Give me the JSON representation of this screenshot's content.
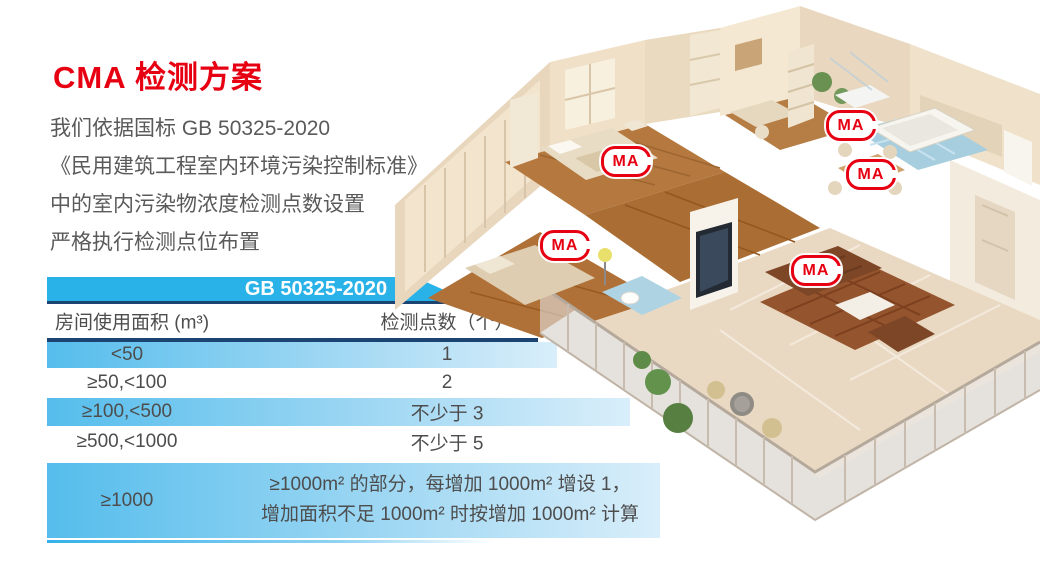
{
  "title": "CMA 检测方案",
  "intro": {
    "line1": "我们依据国标 GB 50325-2020",
    "line2": "《民用建筑工程室内环境污染控制标准》",
    "line3": "中的室内污染物浓度检测点数设置",
    "line4": "严格执行检测点位布置"
  },
  "table": {
    "header": "GB 50325-2020",
    "col1_header": "房间使用面积 (m³)",
    "col2_header": "检测点数（个）",
    "rows": [
      {
        "area": "<50",
        "points": "1"
      },
      {
        "area": "≥50,<100",
        "points": "2"
      },
      {
        "area": "≥100,<500",
        "points": "不少于 3"
      },
      {
        "area": "≥500,<1000",
        "points": "不少于 5"
      }
    ],
    "last_row": {
      "area": "≥1000",
      "points_line1": "≥1000m² 的部分，每增加 1000m² 增设 1，",
      "points_line2": "增加面积不足 1000m² 时按增加 1000m² 计算"
    }
  },
  "floorplan": {
    "badge_label": "MA"
  },
  "colors": {
    "accent_red": "#e60012",
    "header_blue": "#29b2e8",
    "navy_line": "#1c4473",
    "row_blue": "#55bdec",
    "body_text": "#5a5a5a"
  }
}
